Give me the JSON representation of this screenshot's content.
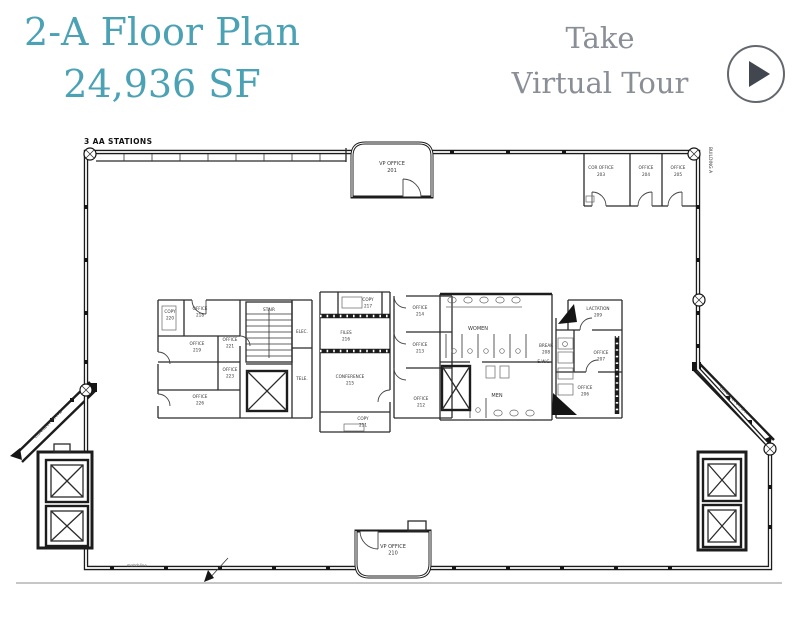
{
  "header": {
    "title_line1": "2-A Floor Plan",
    "title_line2": "24,936 SF",
    "cta_line1": "Take",
    "cta_line2": "Virtual Tour",
    "accent_color": "#4BA2B4",
    "cta_color": "#8A8E96"
  },
  "plan": {
    "annotations": {
      "stations": "3 AA STATIONS",
      "building": "BUILDING A",
      "connector_left": "CONNECTOR A-B",
      "connector_right": "CONNECTOR B-A",
      "matchline": "matchline"
    },
    "rooms": {
      "vp201": {
        "n": "VP OFFICE",
        "id": "201"
      },
      "cor203": {
        "n": "COR OFFICE",
        "id": "203"
      },
      "o204": {
        "n": "OFFICE",
        "id": "204"
      },
      "o205": {
        "n": "OFFICE",
        "id": "205"
      },
      "copy220": {
        "n": "COPY",
        "id": "220"
      },
      "o218": {
        "n": "OFFICE",
        "id": "218"
      },
      "o219": {
        "n": "OFFICE",
        "id": "219"
      },
      "o221": {
        "n": "OFFICE",
        "id": "221"
      },
      "o223": {
        "n": "OFFICE",
        "id": "223"
      },
      "o226": {
        "n": "OFFICE",
        "id": "226"
      },
      "stair": {
        "n": "STAIR"
      },
      "elec": {
        "n": "ELEC."
      },
      "tele": {
        "n": "TELE."
      },
      "copy217": {
        "n": "COPY",
        "id": "217"
      },
      "files216": {
        "n": "FILES",
        "id": "216"
      },
      "conf215": {
        "n": "CONFERENCE",
        "id": "215"
      },
      "copy211": {
        "n": "COPY",
        "id": "211"
      },
      "o214": {
        "n": "OFFICE",
        "id": "214"
      },
      "o213": {
        "n": "OFFICE",
        "id": "213"
      },
      "o212": {
        "n": "OFFICE",
        "id": "212"
      },
      "women": {
        "n": "WOMEN"
      },
      "men": {
        "n": "MEN"
      },
      "break208": {
        "n": "BREAK",
        "id": "208"
      },
      "ewc": {
        "n": "E.W.C."
      },
      "lact209": {
        "n": "LACTATION",
        "id": "209"
      },
      "o207": {
        "n": "OFFICE",
        "id": "207"
      },
      "o206": {
        "n": "OFFICE",
        "id": "206"
      },
      "vp210": {
        "n": "VP OFFICE",
        "id": "210"
      }
    }
  }
}
